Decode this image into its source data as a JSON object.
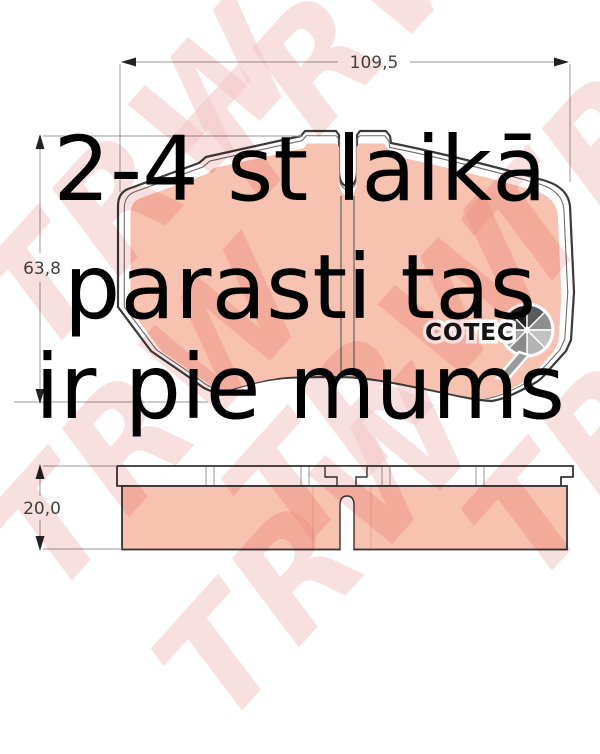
{
  "overlay_text": {
    "line1": "2-4 st laikā",
    "line2": "parasti tas",
    "line3": "ir pie mums"
  },
  "dimensions": {
    "width_label": "109,5",
    "height_label": "63,8",
    "thickness_label": "20,0"
  },
  "logo": {
    "name": "COTEC"
  },
  "brand": {
    "watermark": "TRW"
  },
  "colors": {
    "pad_fill": "#f8c2b0",
    "outline": "#3a3a3a",
    "dimension_line": "#999999",
    "dimension_text": "#444444",
    "watermark_pink": "#f3c1c1",
    "overlay_text_color": "#000000"
  }
}
